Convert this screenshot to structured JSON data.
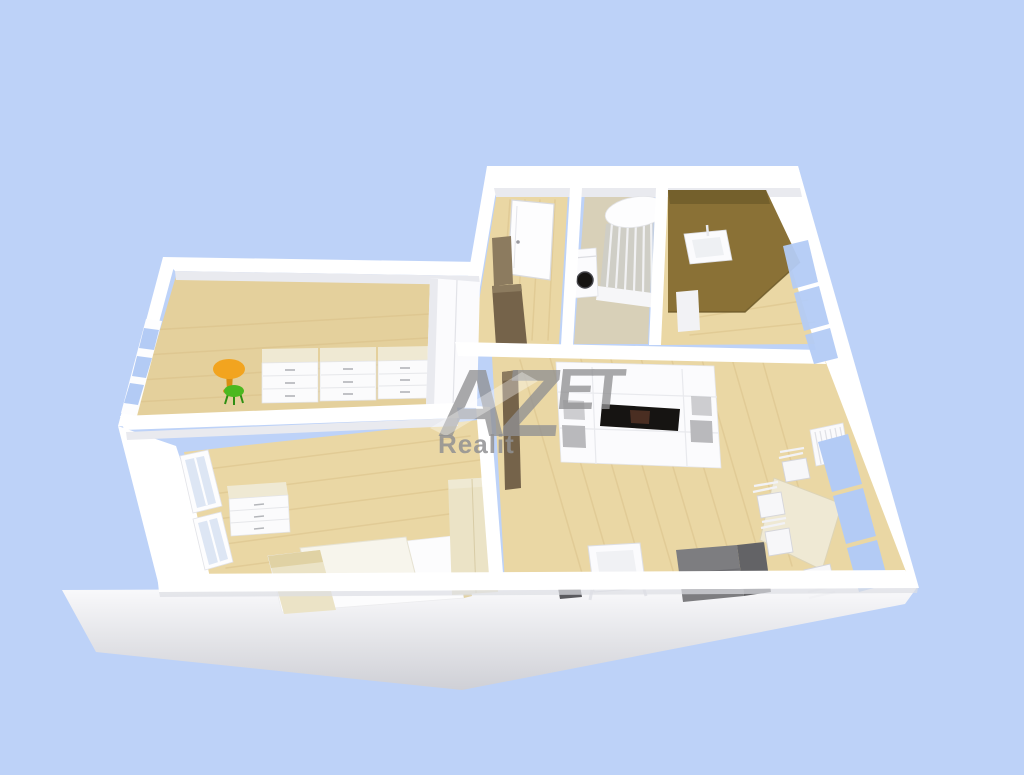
{
  "watermark": {
    "brand_az": "AZ",
    "brand_et": "ET",
    "subtitle": "Realit"
  },
  "colors": {
    "background": "#bdd2f8",
    "slab-light": "#f4f4f7",
    "slab-dark": "#cfd0d6",
    "wall": "#ffffff",
    "wall-shade": "#e9eaef",
    "wall-edge": "#dddee4",
    "floor-wood": "#ead7a4",
    "floor-wood-dark": "#d8bd84",
    "floor-kids": "#e4d09c",
    "floor-greige": "#d8d0b8",
    "bath-brown": "#8a7136",
    "bath-brown-dark": "#74602c",
    "glass-blue": "#b3cbf5",
    "glass-pale": "#dde6f4",
    "cream": "#ebe3c6",
    "cream-top": "#efe9d3",
    "taupe": "#8c7b5f",
    "taupe-dark": "#75634a",
    "sofa-gray": "#7d7d80",
    "sofa-gray-dark": "#636366",
    "shelf-gray": "#b9b9bc",
    "tv-black": "#161412",
    "table-orange": "#f2a41f",
    "table-orange-dark": "#d98d12",
    "stool-green": "#4cb81f",
    "dark-object": "#5a5a5e",
    "watermark-gray": "#919193"
  }
}
